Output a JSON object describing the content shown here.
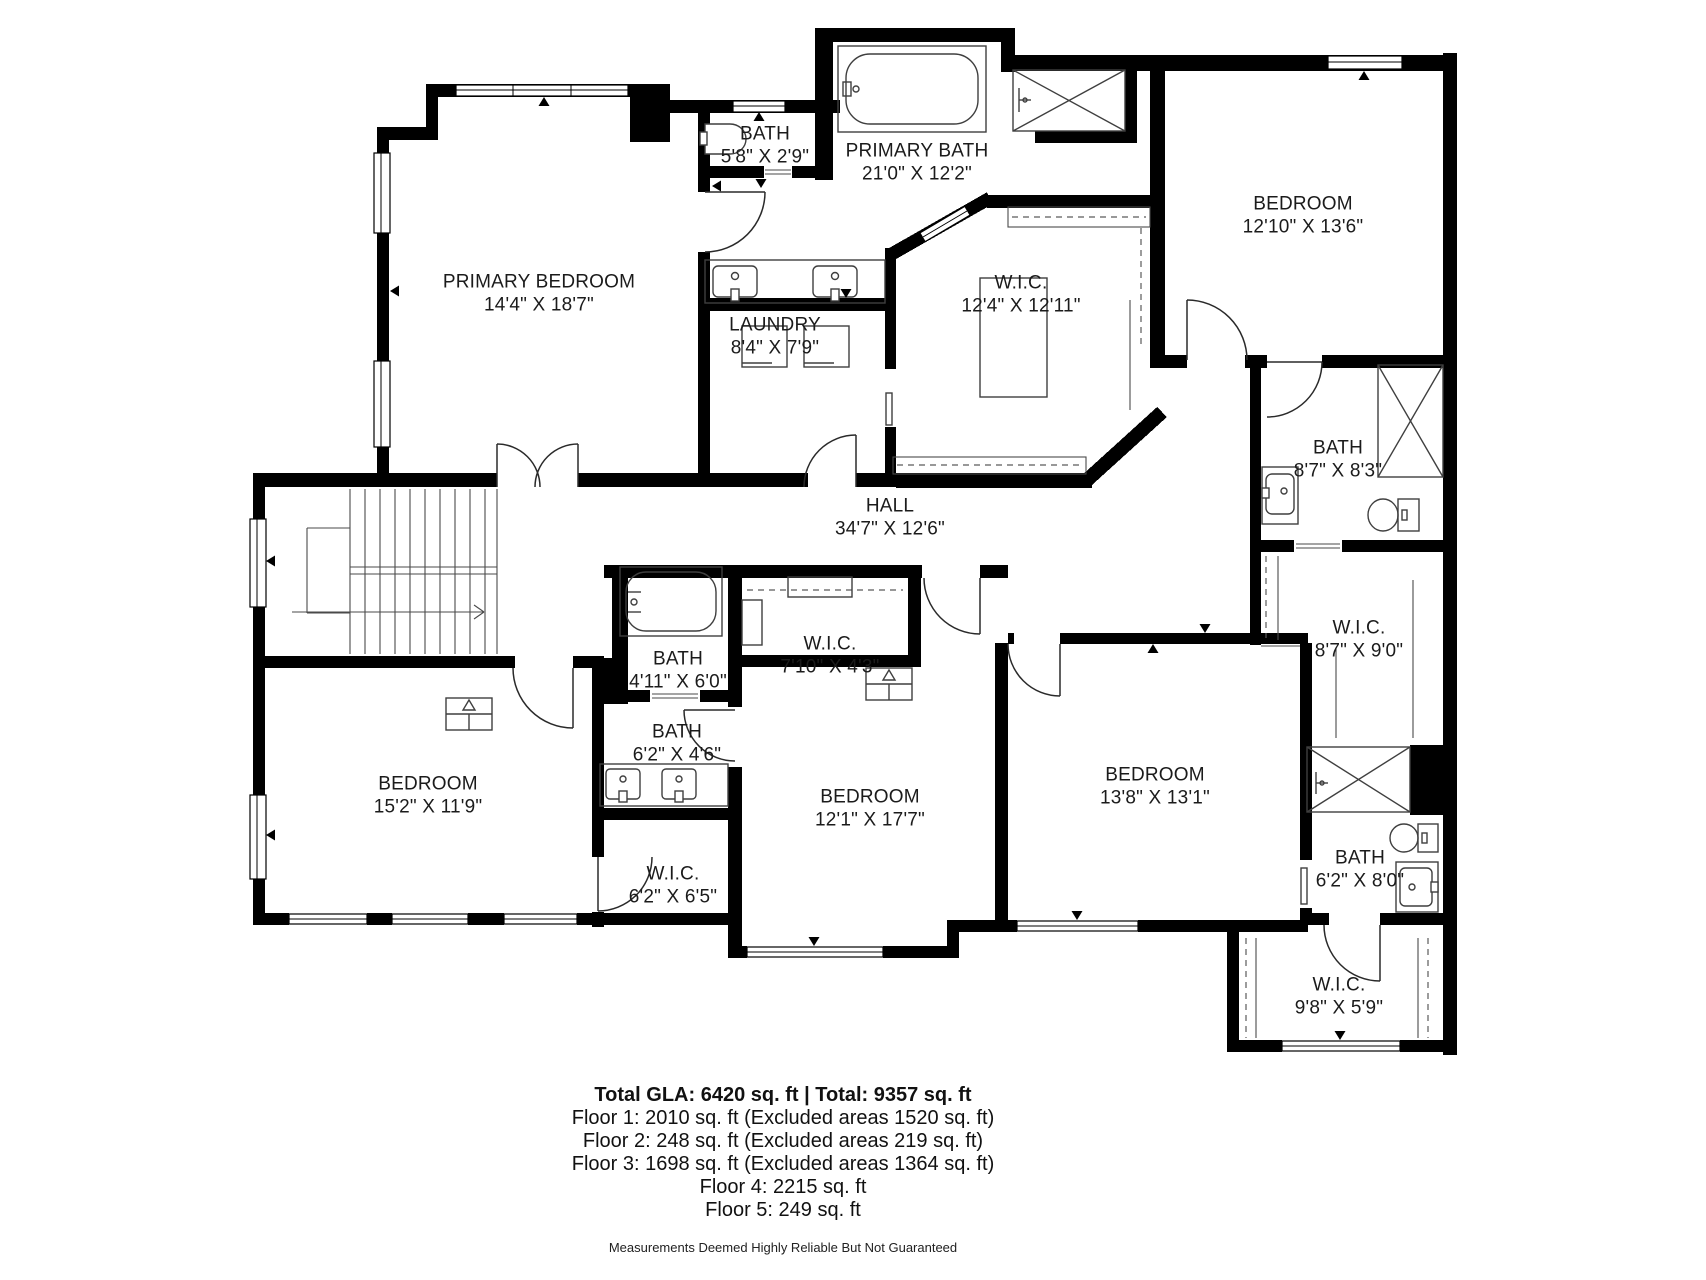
{
  "colors": {
    "walls": "#000000",
    "text": "#1b1b1b"
  },
  "plan": {
    "rooms": [
      {
        "id": "primary-bedroom",
        "name": "PRIMARY BEDROOM",
        "dims": "14'4\" X 18'7\"",
        "x": 539,
        "y": 294
      },
      {
        "id": "bath-top",
        "name": "BATH",
        "dims": "5'8\" X 2'9\"",
        "x": 765,
        "y": 146
      },
      {
        "id": "primary-bath",
        "name": "PRIMARY BATH",
        "dims": "21'0\" X 12'2\"",
        "x": 917,
        "y": 163
      },
      {
        "id": "bedroom-top-right",
        "name": "BEDROOM",
        "dims": "12'10\" X 13'6\"",
        "x": 1303,
        "y": 216
      },
      {
        "id": "laundry",
        "name": "LAUNDRY",
        "dims": "8'4\" X 7'9\"",
        "x": 775,
        "y": 337
      },
      {
        "id": "wic-primary",
        "name": "W.I.C.",
        "dims": "12'4\" X 12'11\"",
        "x": 1021,
        "y": 295
      },
      {
        "id": "bath-right",
        "name": "BATH",
        "dims": "8'7\" X 8'3\"",
        "x": 1338,
        "y": 460
      },
      {
        "id": "hall",
        "name": "HALL",
        "dims": "34'7\" X 12'6\"",
        "x": 890,
        "y": 518
      },
      {
        "id": "wic-right",
        "name": "W.I.C.",
        "dims": "8'7\" X 9'0\"",
        "x": 1359,
        "y": 640
      },
      {
        "id": "bath-small",
        "name": "BATH",
        "dims": "4'11\" X 6'0\"",
        "x": 678,
        "y": 671
      },
      {
        "id": "wic-middle",
        "name": "W.I.C.",
        "dims": "7'10\" X 4'3\"",
        "x": 830,
        "y": 656
      },
      {
        "id": "bath-jack-jill",
        "name": "BATH",
        "dims": "6'2\" X 4'6\"",
        "x": 677,
        "y": 744
      },
      {
        "id": "bedroom-left",
        "name": "BEDROOM",
        "dims": "15'2\" X 11'9\"",
        "x": 428,
        "y": 796
      },
      {
        "id": "wic-left",
        "name": "W.I.C.",
        "dims": "6'2\" X 6'5\"",
        "x": 673,
        "y": 886
      },
      {
        "id": "bedroom-middle",
        "name": "BEDROOM",
        "dims": "12'1\" X 17'7\"",
        "x": 870,
        "y": 809
      },
      {
        "id": "bedroom-right",
        "name": "BEDROOM",
        "dims": "13'8\" X 13'1\"",
        "x": 1155,
        "y": 787
      },
      {
        "id": "bath-bottom-right",
        "name": "BATH",
        "dims": "6'2\" X 8'0\"",
        "x": 1360,
        "y": 870
      },
      {
        "id": "wic-bottom-right",
        "name": "W.I.C.",
        "dims": "9'8\" X 5'9\"",
        "x": 1339,
        "y": 997
      }
    ],
    "footer": {
      "total": "Total GLA: 6420 sq. ft | Total: 9357 sq. ft",
      "floors": [
        "Floor 1: 2010 sq. ft (Excluded areas 1520 sq. ft)",
        "Floor 2: 248 sq. ft (Excluded areas 219 sq. ft)",
        "Floor 3: 1698 sq. ft (Excluded areas 1364 sq. ft)",
        "Floor 4: 2215 sq. ft",
        "Floor 5: 249 sq. ft"
      ],
      "disclaimer": "Measurements Deemed Highly Reliable But Not Guaranteed"
    }
  }
}
